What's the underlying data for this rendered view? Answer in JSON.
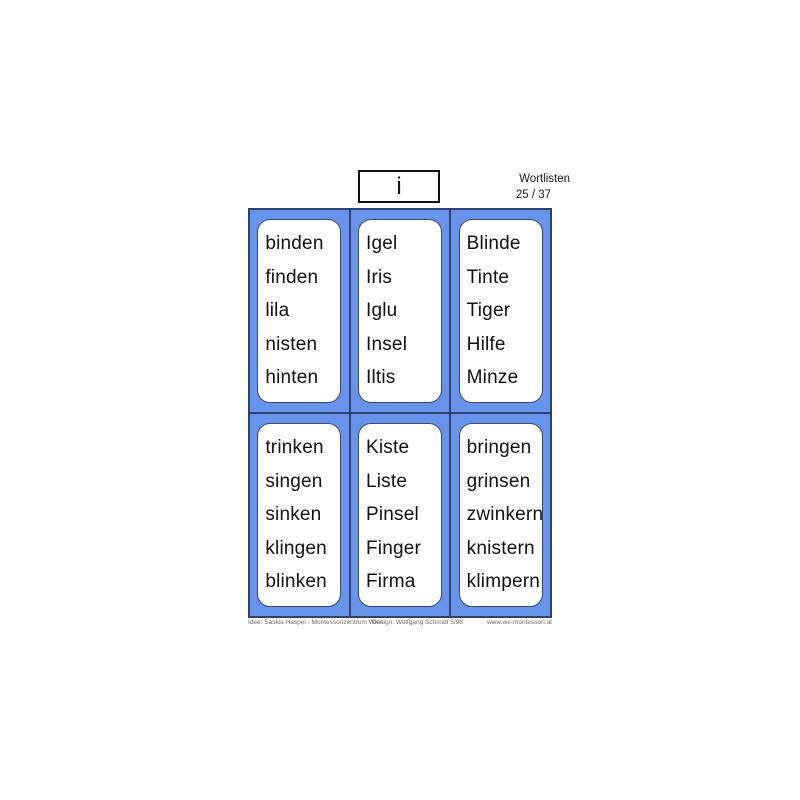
{
  "header": {
    "letter": "i",
    "title": "Wortlisten",
    "page": "25 / 37"
  },
  "cards": [
    {
      "words": [
        "binden",
        "finden",
        "lila",
        "nisten",
        "hinten"
      ]
    },
    {
      "words": [
        "Igel",
        "Iris",
        "Iglu",
        "Insel",
        "Iltis"
      ]
    },
    {
      "words": [
        "Blinde",
        "Tinte",
        "Tiger",
        "Hilfe",
        "Minze"
      ]
    },
    {
      "words": [
        "trinken",
        "singen",
        "sinken",
        "klingen",
        "blinken"
      ]
    },
    {
      "words": [
        "Kiste",
        "Liste",
        "Pinsel",
        "Finger",
        "Firma"
      ]
    },
    {
      "words": [
        "bringen",
        "grinsen",
        "zwinkern",
        "knistern",
        "klimpern"
      ]
    }
  ],
  "footer": {
    "idea": "Idee: Saskia Haspel - Montessorizentrum Wien",
    "design": "Design: Wolfgang Schmidt 5/98",
    "website": "www.we-montessori.at"
  },
  "colors": {
    "cell_blue": "#6793EA",
    "grid_line": "#31406F",
    "card_border": "#3A4A78"
  }
}
